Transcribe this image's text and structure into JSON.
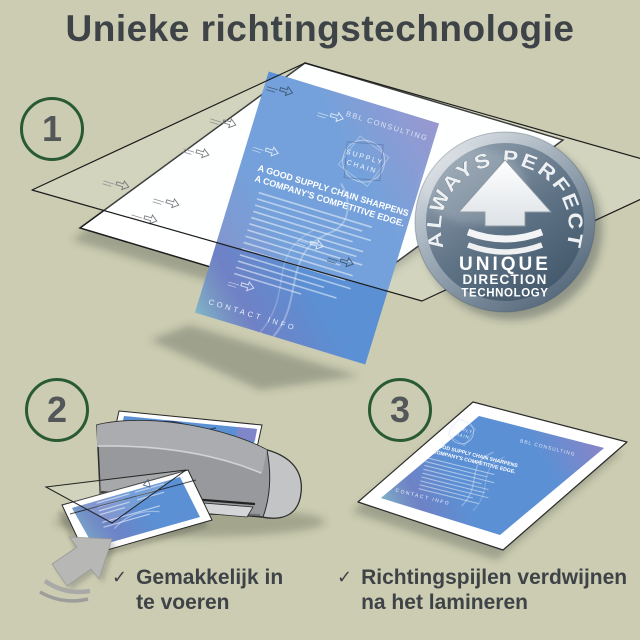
{
  "title": "Unieke richtingstechnologie",
  "steps": {
    "one": "1",
    "two": "2",
    "three": "3"
  },
  "badge": {
    "arc": "ALWAYS PERFECT!",
    "word1": "UNIQUE",
    "word2": "DIRECTION",
    "word3": "TECHNOLOGY"
  },
  "document": {
    "brand": "BBL CONSULTING",
    "logo1": "SUPPLY",
    "logo2": "CHAIN",
    "headline1": "A GOOD SUPPLY CHAIN SHARPENS",
    "headline2": "A COMPANY'S COMPETITIVE EDGE.",
    "footer": "CONTACT INFO"
  },
  "captions": {
    "left_check": "✓",
    "left_line1": "Gemakkelijk in",
    "left_line2": "te voeren",
    "right_check": "✓",
    "right_line1": "Richtingspijlen verdwijnen",
    "right_line2": "na het lamineren"
  },
  "colors": {
    "background": "#cbccb1",
    "title_text": "#3e4347",
    "step_circle_green": "#2a5a33",
    "document_blue": "#5b90d4",
    "accent_violet": "#8b84c6",
    "accent_teal": "#83b9c5",
    "badge_metal_dark": "#46596c",
    "badge_metal_light": "#eef1f3",
    "laminator_gray": "#97999c"
  }
}
